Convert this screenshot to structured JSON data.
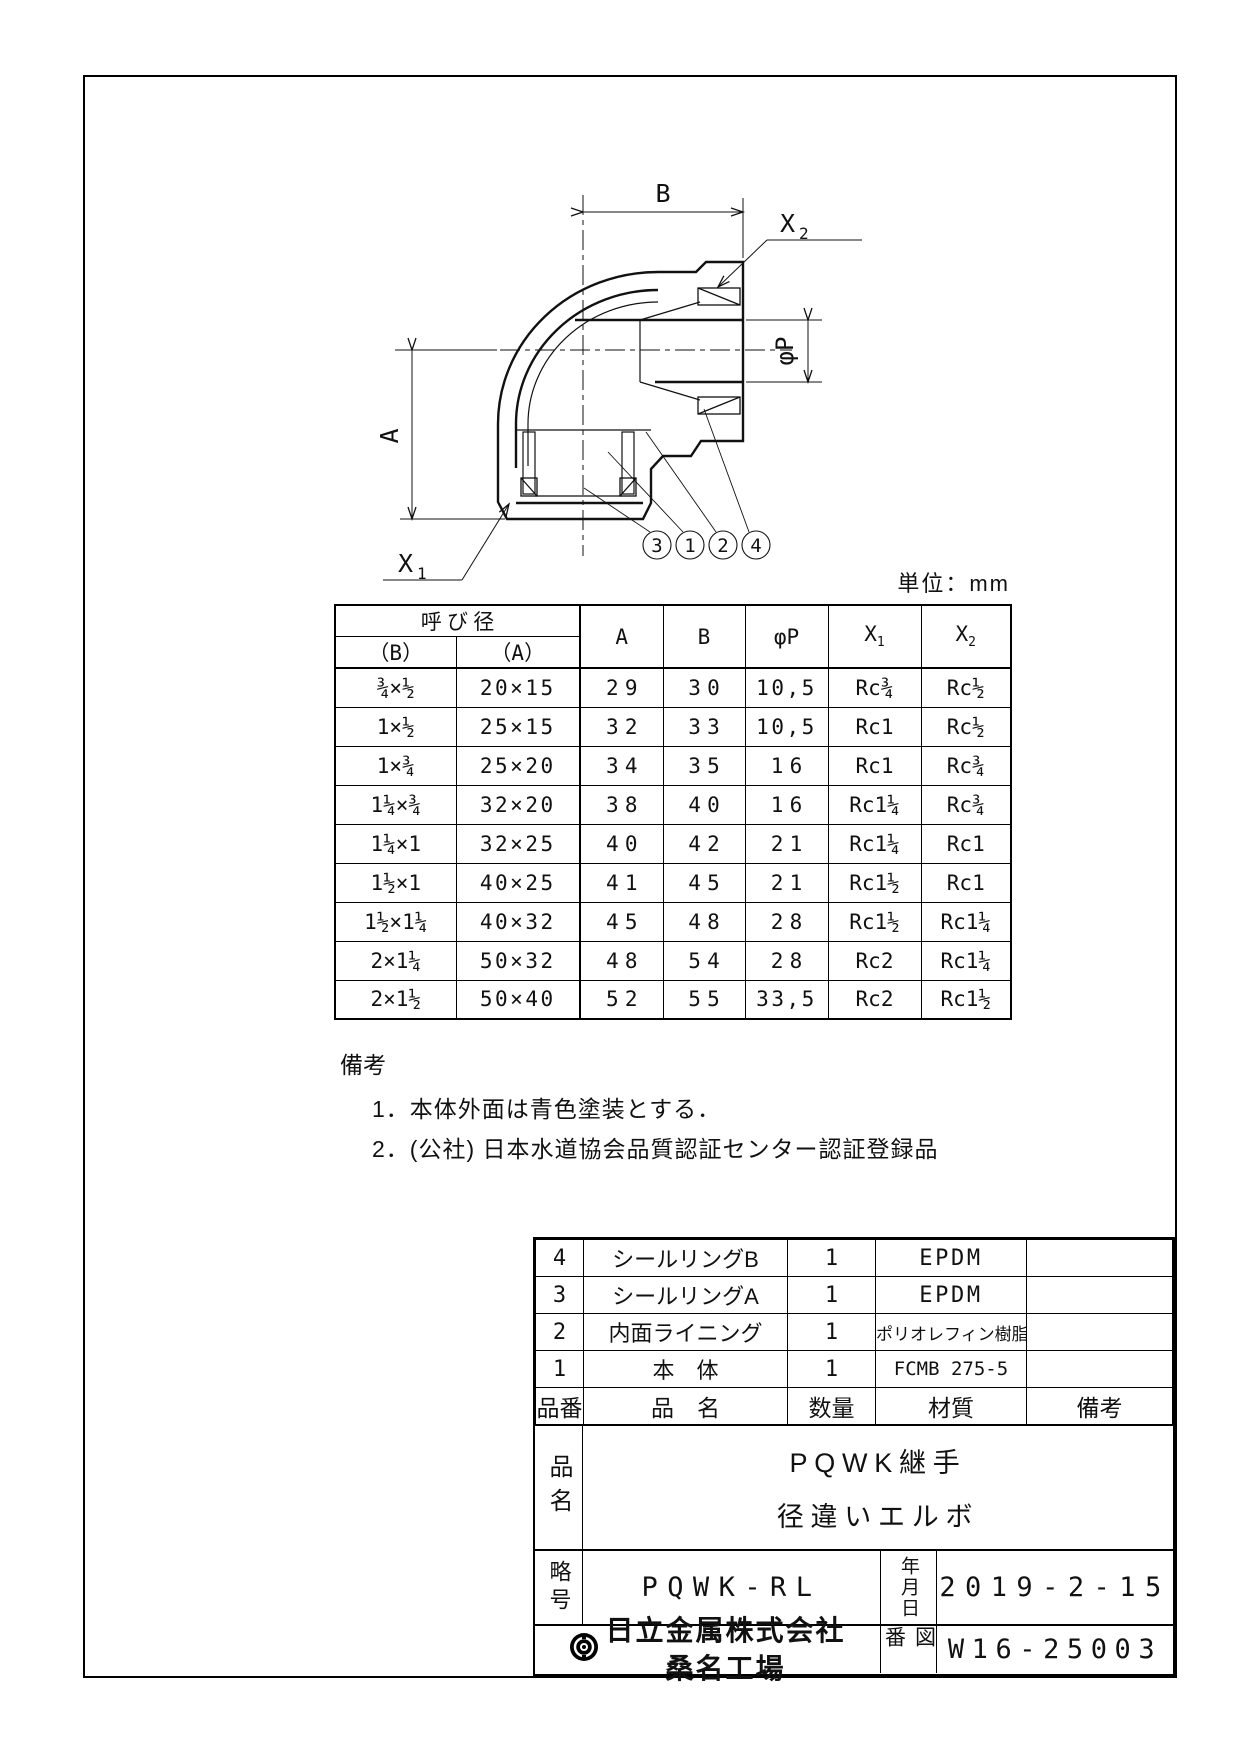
{
  "unit_note": "単位：mm",
  "drawing": {
    "dim_a": "A",
    "dim_b": "B",
    "dim_phi_p": "φP",
    "label_x1_base": "X",
    "label_x1_sub": "1",
    "label_x2_base": "X",
    "label_x2_sub": "2",
    "balloons": [
      "3",
      "1",
      "2",
      "4"
    ]
  },
  "dimension_table": {
    "group_header": "呼び径",
    "sub_b": "（B）",
    "sub_a": "（A）",
    "col_a": "A",
    "col_b": "B",
    "col_p": "φP",
    "col_x1_base": "X",
    "col_x1_sub": "1",
    "col_x2_base": "X",
    "col_x2_sub": "2",
    "rows": [
      {
        "nb": "¾×½",
        "na": "20×15",
        "a": "29",
        "b": "30",
        "p": "10,5",
        "x1": "Rc¾",
        "x2": "Rc½"
      },
      {
        "nb": "1×½",
        "na": "25×15",
        "a": "32",
        "b": "33",
        "p": "10,5",
        "x1": "Rc1",
        "x2": "Rc½"
      },
      {
        "nb": "1×¾",
        "na": "25×20",
        "a": "34",
        "b": "35",
        "p": "16",
        "x1": "Rc1",
        "x2": "Rc¾"
      },
      {
        "nb": "1¼×¾",
        "na": "32×20",
        "a": "38",
        "b": "40",
        "p": "16",
        "x1": "Rc1¼",
        "x2": "Rc¾"
      },
      {
        "nb": "1¼×1",
        "na": "32×25",
        "a": "40",
        "b": "42",
        "p": "21",
        "x1": "Rc1¼",
        "x2": "Rc1"
      },
      {
        "nb": "1½×1",
        "na": "40×25",
        "a": "41",
        "b": "45",
        "p": "21",
        "x1": "Rc1½",
        "x2": "Rc1"
      },
      {
        "nb": "1½×1¼",
        "na": "40×32",
        "a": "45",
        "b": "48",
        "p": "28",
        "x1": "Rc1½",
        "x2": "Rc1¼"
      },
      {
        "nb": "2×1¼",
        "na": "50×32",
        "a": "48",
        "b": "54",
        "p": "28",
        "x1": "Rc2",
        "x2": "Rc1¼"
      },
      {
        "nb": "2×1½",
        "na": "50×40",
        "a": "52",
        "b": "55",
        "p": "33,5",
        "x1": "Rc2",
        "x2": "Rc1½"
      }
    ]
  },
  "notes": {
    "title": "備考",
    "item1": "1．本体外面は青色塗装とする．",
    "item2": "2．(公社) 日本水道協会品質認証センター認証登録品"
  },
  "parts_table": {
    "rows": [
      {
        "no": "4",
        "name": "シールリングB",
        "qty": "1",
        "material": "EPDM",
        "remark": ""
      },
      {
        "no": "3",
        "name": "シールリングA",
        "qty": "1",
        "material": "EPDM",
        "remark": ""
      },
      {
        "no": "2",
        "name": "内面ライニング",
        "qty": "1",
        "material": "ポリオレフィン樹脂",
        "remark": ""
      },
      {
        "no": "1",
        "name": "本　体",
        "qty": "1",
        "material": "FCMB 275-5",
        "remark": ""
      }
    ],
    "header": {
      "no": "品番",
      "name": "品　名",
      "qty": "数量",
      "material": "材質",
      "remark": "備考"
    }
  },
  "title_block": {
    "name_label": "品名",
    "product_line1": "PQWK継手",
    "product_line2": "径違いエルボ",
    "code_label": "略号",
    "code": "PQWK-RL",
    "date_label": "年月日",
    "date": "2019-2-15",
    "company": "日立金属株式会社",
    "factory": "桑名工場",
    "dwg_label": "図番",
    "dwg_no": "W16-25003"
  }
}
